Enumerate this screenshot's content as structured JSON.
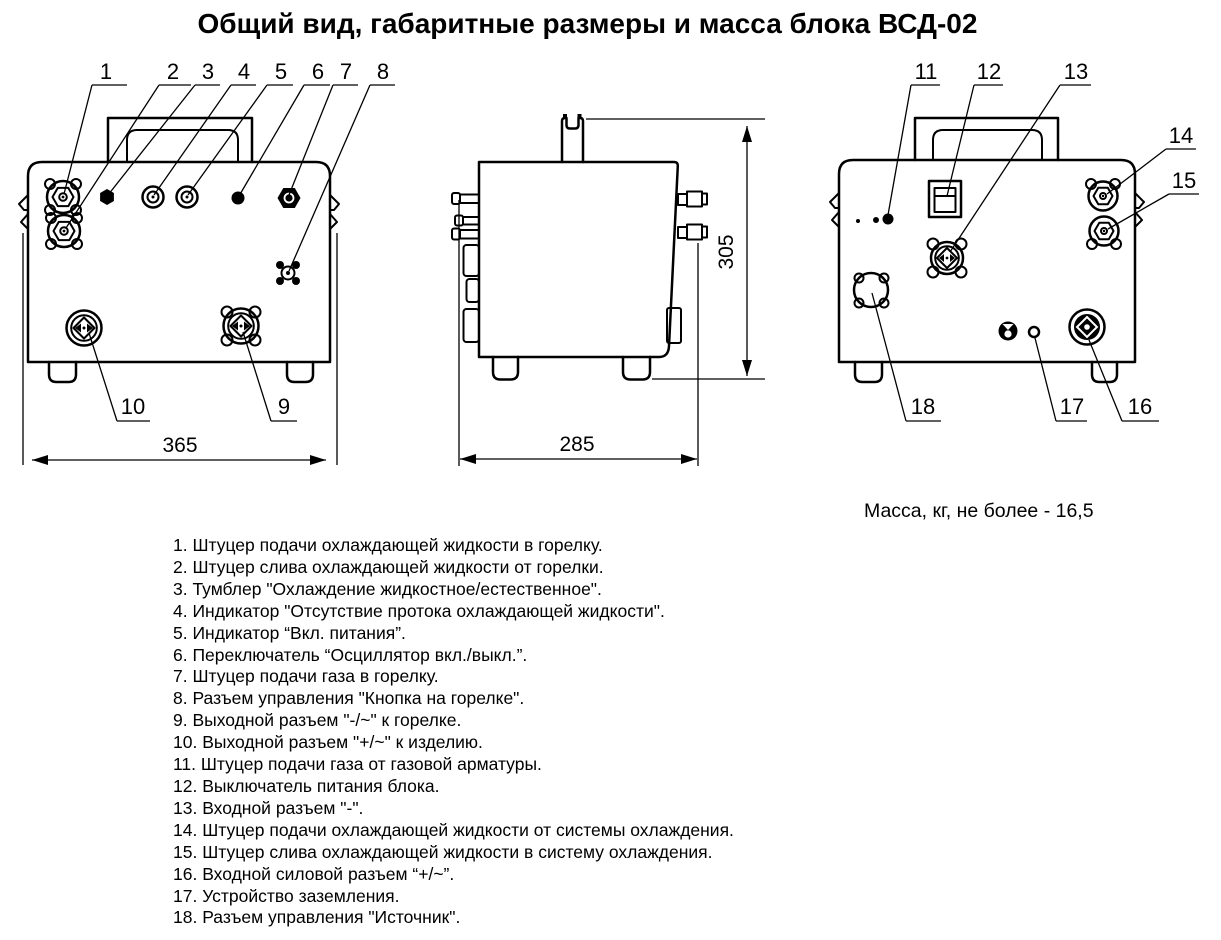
{
  "title": "Общий вид, габаритные размеры и масса блока ВСД-02",
  "mass_note": "Масса, кг, не более - 16,5",
  "dimensions": {
    "front_width": "365",
    "side_depth": "285",
    "height": "305"
  },
  "callouts": {
    "c1": "1",
    "c2": "2",
    "c3": "3",
    "c4": "4",
    "c5": "5",
    "c6": "6",
    "c7": "7",
    "c8": "8",
    "c9": "9",
    "c10": "10",
    "c11": "11",
    "c12": "12",
    "c13": "13",
    "c14": "14",
    "c15": "15",
    "c16": "16",
    "c17": "17",
    "c18": "18"
  },
  "legend": [
    "1. Штуцер подачи охлаждающей жидкости в горелку.",
    "2. Штуцер слива охлаждающей жидкости от горелки.",
    "3. Тумблер \"Охлаждение жидкостное/естественное\".",
    "4. Индикатор \"Отсутствие протока охлаждающей жидкости\".",
    "5. Индикатор “Вкл. питания”.",
    "6. Переключатель “Осциллятор вкл./выкл.”.",
    "7. Штуцер подачи газа в горелку.",
    "8. Разъем управления \"Кнопка на горелке\".",
    "9. Выходной разъем \"-/~\" к горелке.",
    "10. Выходной разъем \"+/~\" к изделию.",
    "11. Штуцер подачи газа от газовой арматуры.",
    "12. Выключатель питания блока.",
    "13. Входной разъем \"-\".",
    "14. Штуцер подачи охлаждающей жидкости от системы охлаждения.",
    "15. Штуцер слива охлаждающей жидкости в систему охлаждения.",
    "16. Входной силовой разъем “+/~”.",
    "17. Устройство заземления.",
    "18. Разъем управления \"Источник\"."
  ]
}
